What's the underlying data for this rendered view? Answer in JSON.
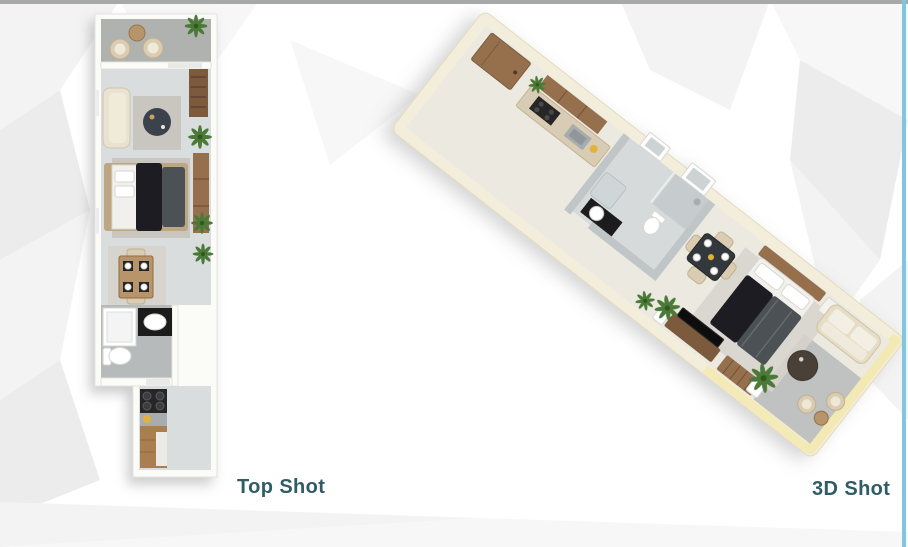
{
  "labels": {
    "top_shot": "Top Shot",
    "three_d_shot": "3D Shot"
  },
  "views": {
    "top_shot": {
      "label": "Top Shot",
      "type": "2d-top-down-floorplan",
      "elements": [
        "balcony",
        "living-room",
        "bedroom",
        "dining-area",
        "bathroom",
        "kitchen-corridor"
      ]
    },
    "three_d_shot": {
      "label": "3D Shot",
      "type": "isometric-3d-floorplan",
      "elements": [
        "entrance-door",
        "kitchen",
        "bathroom",
        "dining-area",
        "bedroom",
        "living-area",
        "terrace"
      ]
    }
  },
  "palette": {
    "bg": "#ffffff",
    "border_gray": "#a7a9a8",
    "border_blue": "#7fc6e0",
    "label_teal": "#305c66",
    "wall_white": "#fbfbf8",
    "wall_cream": "#f3eedb",
    "wall_yellow": "#f3e9b4",
    "floor_light": "#dadddd",
    "floor_cream": "#eceae0",
    "floor_balcony": "#b0b2af",
    "floor_bath": "#b6babb",
    "floor_terrace": "#bfc2c0",
    "rug": "#c9c6c0",
    "rug_light": "#d7d4cd",
    "wood_dark": "#7b5a3e",
    "wood_mid": "#96704d",
    "wood_light": "#b8946a",
    "wood_counter": "#a97f4f",
    "sofa_cream": "#e9e2d1",
    "chair_beige": "#d9ccb2",
    "bed_white": "#f1f0ec",
    "bed_dark": "#1e1f21",
    "bed_gray": "#4c5155",
    "table_dark": "#3a434c",
    "appliance_black": "#252527",
    "steel": "#a7acae",
    "marble_wall": "#c0c5c7",
    "vanity_black": "#1c1c1e",
    "plant_green": "#4c7a38",
    "plant_dark": "#33591f",
    "accent_yellow": "#e3b23a",
    "tan_head": "#bda684",
    "facet_a": "#f3f3f3",
    "facet_b": "#ececec",
    "facet_c": "#f7f7f7"
  }
}
